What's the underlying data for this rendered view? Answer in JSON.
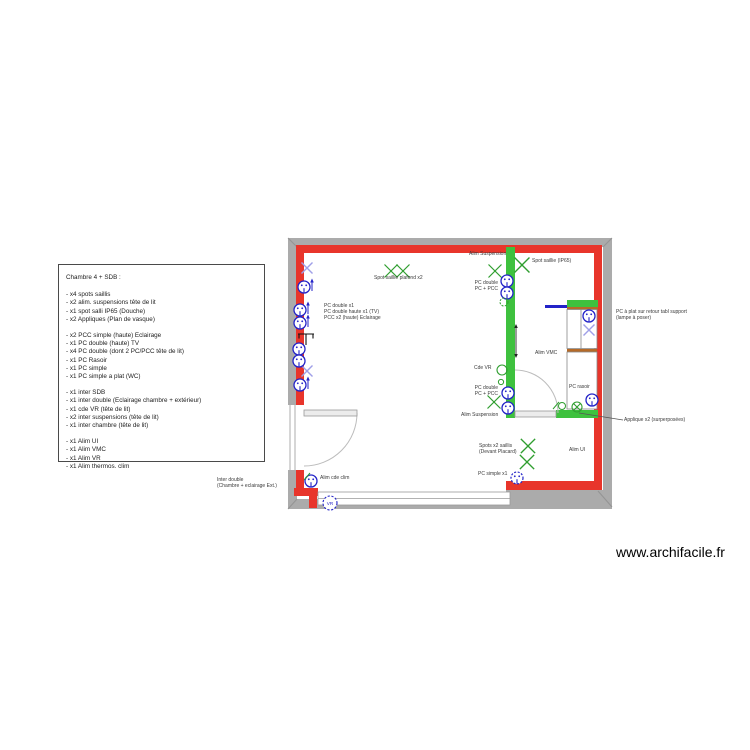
{
  "page": {
    "watermark": "www.archifacile.fr"
  },
  "legend": {
    "title": "Chambre 4 + SDB :",
    "groups": [
      {
        "items": [
          "- x4 spots saillis",
          "- x2 alim. suspensions tête de lit",
          "- x1 spot salli IP65 (Douche)",
          "- x2 Appliques (Plan de vasque)"
        ]
      },
      {
        "items": [
          "- x2 PCC simple (haute) Eclairage",
          "- x1 PC double (haute) TV",
          "- x4 PC double (dont 2 PC/PCC tête de lit)",
          "- x1 PC Rasoir",
          "- x1 PC simple",
          "- x1 PC simple a plat (WC)"
        ]
      },
      {
        "items": [
          "- x1 inter SDB",
          "- x1 inter double (Eclairage chambre + extérieur)",
          "- x1 cde VR (tête de lit)",
          "- x2 inter suspensions (tête de lit)",
          "- x1 inter chambre (tête de lit)"
        ]
      },
      {
        "items": [
          "- x1 Alim UI",
          "- x1 Alim VMC",
          "- x1 Alim VR",
          "- x1 Alim thermos. clim"
        ]
      }
    ]
  },
  "plan": {
    "labels": [
      {
        "id": "spot-saillie-plafond",
        "text": "Spot saillie plafond x2"
      },
      {
        "id": "alim-suspension-top",
        "text": "Alim Suspension"
      },
      {
        "id": "spot-saillie-ip65",
        "text": "Spot saillie (IP65)"
      },
      {
        "id": "pc-left-wall",
        "text": "PC double x1\nPC double haute x1 (TV)\nPCC x2 (haute) Eclairage"
      },
      {
        "id": "pc-green-wall-top",
        "text": "PC double\nPC + PCC"
      },
      {
        "id": "cde-vr",
        "text": "Cde VR"
      },
      {
        "id": "alim-vmc",
        "text": "Alim VMC"
      },
      {
        "id": "pc-green-wall-bottom",
        "text": "PC double\nPC + PCC"
      },
      {
        "id": "alim-suspension-bottom",
        "text": "Alim Suspension"
      },
      {
        "id": "pc-rasoir",
        "text": "PC rasoir"
      },
      {
        "id": "pc-a-plat",
        "text": "PC à plat sur retour tabl support\n(lampe à poser)"
      },
      {
        "id": "applique-x2",
        "text": "Applique x2 (surperposées)"
      },
      {
        "id": "spots-devant-placard",
        "text": "Spots x2 saillis\n(Devant Placard)"
      },
      {
        "id": "alim-ui",
        "text": "Alim UI"
      },
      {
        "id": "pc-simple-x1",
        "text": "PC simple x1"
      },
      {
        "id": "alim-cde-clim",
        "text": "Alim cde clim"
      },
      {
        "id": "inter-double",
        "text": "Inter double\n(Chambre + eclairage Ext.)"
      },
      {
        "id": "vr-window",
        "text": "VR"
      }
    ],
    "symbols": {
      "green_x": "ceiling-spot-light",
      "green_circle_x": "wall-applique-light",
      "blue_circle": "power-outlet",
      "blue_dashed_circle": "power-outlet-planned",
      "vr_circle": "roller-shutter-control",
      "black_bracket": "tv-antenna-socket"
    },
    "colors": {
      "wall_red": "#e8352b",
      "wall_gray": "#ababab",
      "wall_green": "#3ec13e",
      "symbol_green": "#2f9e2f",
      "symbol_blue": "#2323c8",
      "symbol_violet": "#9f9fe8",
      "wood_brown": "#b56a28"
    }
  }
}
